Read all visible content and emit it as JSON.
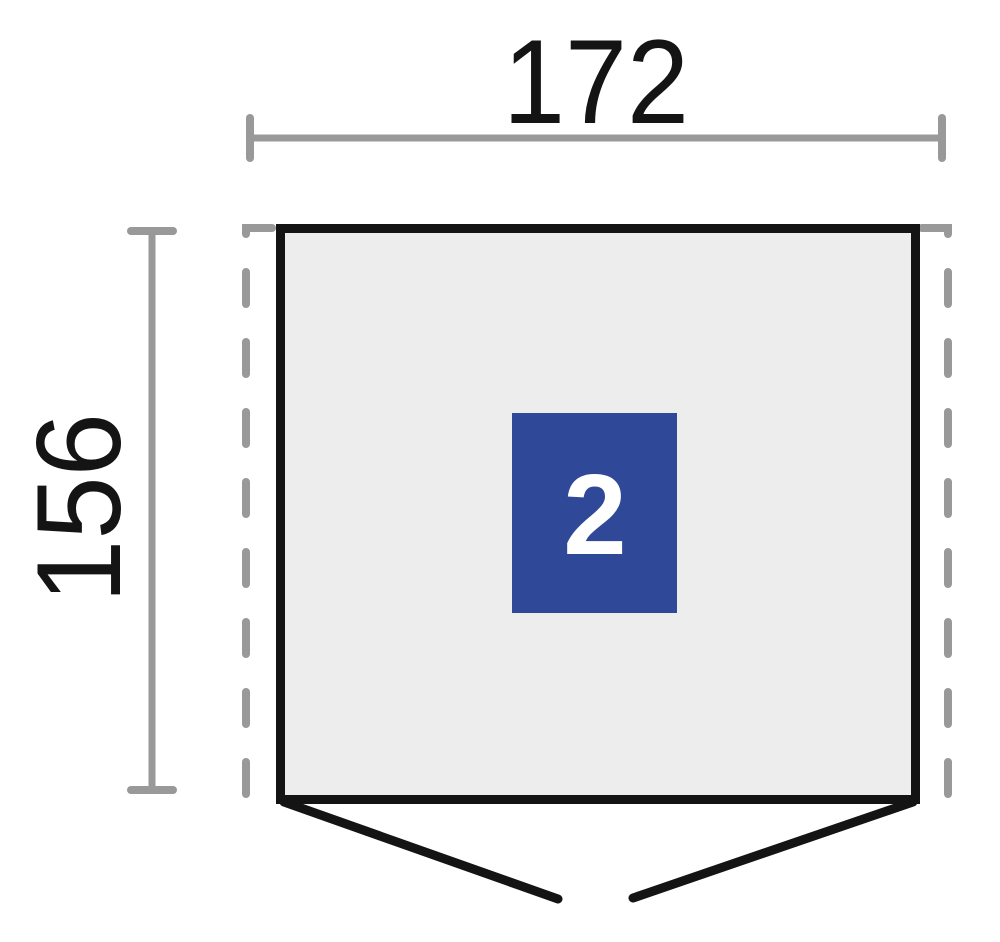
{
  "diagram": {
    "kind": "shed-floor-plan",
    "dimensions": {
      "width_label": "172",
      "height_label": "156"
    },
    "zone": {
      "label": "2"
    },
    "colors": {
      "background": "#ffffff",
      "dimension_gray": "#999999",
      "dashed_outline_gray": "#999999",
      "outline_black": "#141414",
      "floor_fill": "#ededed",
      "zone_fill": "#2f4897",
      "zone_label_color": "#ffffff",
      "label_color": "#141414"
    }
  }
}
